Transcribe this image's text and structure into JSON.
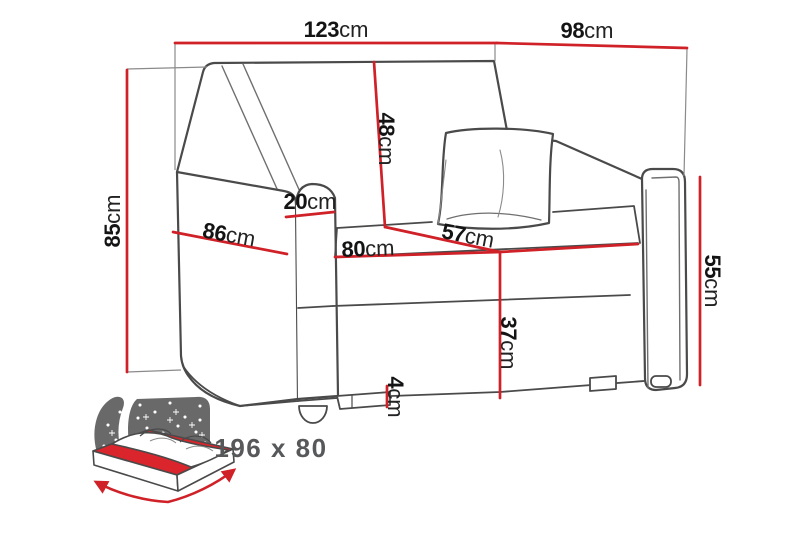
{
  "diagram": {
    "type": "furniture-dimension-diagram",
    "subject": "armchair sofa-bed with dimension lines",
    "dims": {
      "total_width": {
        "num": "123",
        "unit": "cm"
      },
      "total_depth": {
        "num": "98",
        "unit": "cm"
      },
      "total_height": {
        "num": "85",
        "unit": "cm"
      },
      "backrest_height": {
        "num": "48",
        "unit": "cm"
      },
      "armrest_width": {
        "num": "20",
        "unit": "cm"
      },
      "side_depth": {
        "num": "86",
        "unit": "cm"
      },
      "seat_width": {
        "num": "80",
        "unit": "cm"
      },
      "seat_depth": {
        "num": "57",
        "unit": "cm"
      },
      "seat_height": {
        "num": "37",
        "unit": "cm"
      },
      "armrest_height": {
        "num": "55",
        "unit": "cm"
      },
      "leg_height": {
        "num": "4",
        "unit": "cm"
      }
    },
    "sleeping_area": {
      "text": "196 x 80"
    },
    "colors": {
      "dimension_line": "#cf2127",
      "outline": "#4a4a4a",
      "label_text": "#141414",
      "bed_icon_gray": "#696969",
      "bed_icon_red": "#d9252b",
      "sleeping_text": "#57585a",
      "background": "#ffffff"
    }
  }
}
